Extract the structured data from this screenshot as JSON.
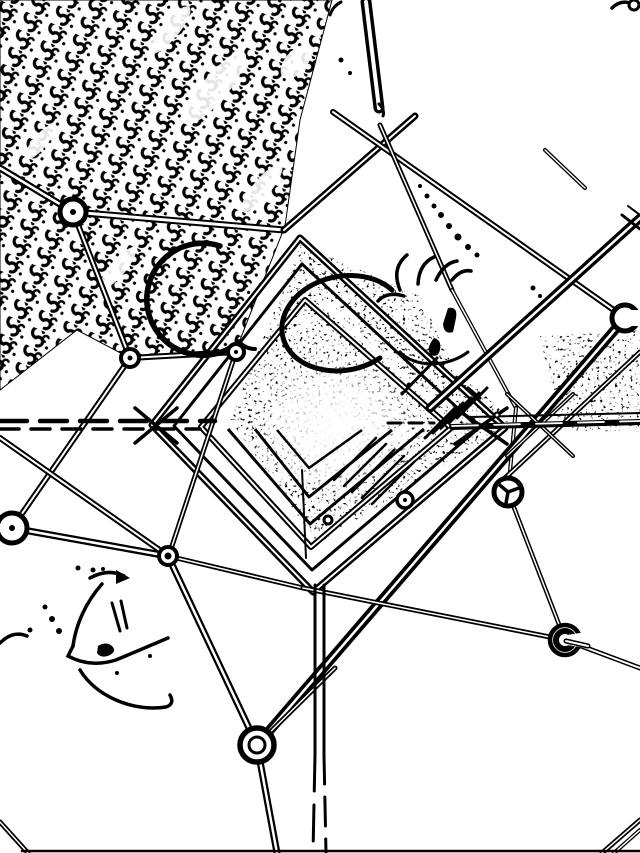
{
  "image": {
    "kind": "edge-detected-photograph",
    "alt": "Black and white edge-detection line art of a lattice tower viewed along its axis: radiating double-line struts with circular ring joints, nested diamond frames around a speckled noisy core, chain-like foliage texture in the upper-left, dashed guide lines, and small curved details",
    "width": 640,
    "height": 853,
    "palette": {
      "ink": "#000000",
      "paper": "#ffffff"
    }
  },
  "scene": {
    "texture": {
      "polygon": "0,0 332,0 300,120 285,226 236,350 130,358 77,330 0,390",
      "white_streaks": [
        [
          215,
          88,
          46,
          13
        ],
        [
          262,
          188,
          30,
          9
        ],
        [
          118,
          268,
          26,
          8
        ],
        [
          40,
          142,
          22,
          7
        ],
        [
          170,
          30,
          30,
          9
        ],
        [
          296,
          62,
          20,
          11
        ]
      ]
    },
    "noise": {
      "polygons": [
        "300,248 516,420 318,544 230,420",
        "540,336 640,330 640,432 560,430",
        "292,240 420,296 468,396 330,302"
      ],
      "fade_center": [
        336,
        428,
        85,
        75
      ],
      "white_streaks": [
        [
          318,
          300,
          430,
          400,
          5
        ],
        [
          280,
          340,
          360,
          290,
          4
        ],
        [
          330,
          480,
          420,
          420,
          4
        ]
      ]
    },
    "diamonds_double": [
      {
        "points": "300,238 505,428 313,592 152,425",
        "bw": 7,
        "ww": 2
      },
      {
        "points": "305,300 451,428 311,547 201,427",
        "bw": 6,
        "ww": 2
      }
    ],
    "diamonds_single": [
      {
        "points": "302,264 479,428 312,570 174,426",
        "w": 3
      }
    ],
    "chevrons": [
      {
        "points": "228,429 310,524 424,429",
        "w": 3
      },
      {
        "points": "255,429 309,497 392,430",
        "w": 3
      },
      {
        "points": "277,430 309,468 362,430",
        "w": 2.5
      }
    ],
    "struts": [
      [
        0,
        168,
        73,
        212,
        7,
        2.5
      ],
      [
        73,
        212,
        284,
        230,
        7,
        3
      ],
      [
        73,
        212,
        130,
        358,
        6,
        2
      ],
      [
        130,
        358,
        236,
        352,
        6,
        2
      ],
      [
        130,
        358,
        12,
        528,
        6,
        2
      ],
      [
        0,
        438,
        168,
        556,
        6,
        2
      ],
      [
        12,
        528,
        168,
        556,
        7,
        2.5
      ],
      [
        168,
        556,
        257,
        745,
        7,
        2.5
      ],
      [
        168,
        556,
        303,
        588,
        5,
        1.5
      ],
      [
        236,
        352,
        170,
        552,
        5,
        1.5
      ],
      [
        284,
        230,
        415,
        116,
        7,
        2
      ],
      [
        333,
        112,
        625,
        318,
        6,
        2
      ],
      [
        380,
        125,
        452,
        290,
        5,
        1.5
      ],
      [
        452,
        290,
        516,
        408,
        4,
        1.5
      ],
      [
        516,
        408,
        508,
        492,
        4,
        1.5
      ],
      [
        508,
        492,
        565,
        640,
        4.5,
        1.5
      ],
      [
        625,
        318,
        257,
        745,
        10,
        2.5
      ],
      [
        640,
        218,
        430,
        408,
        9,
        2.5
      ],
      [
        565,
        640,
        640,
        668,
        5,
        2
      ],
      [
        565,
        640,
        303,
        588,
        5,
        1.5
      ],
      [
        257,
        745,
        277,
        853,
        7,
        2.5
      ],
      [
        257,
        745,
        335,
        668,
        5,
        1.5
      ],
      [
        366,
        2,
        379,
        108,
        11,
        4
      ],
      [
        0,
        822,
        28,
        853,
        5,
        1.5
      ],
      [
        602,
        853,
        640,
        820,
        5,
        1.5
      ],
      [
        614,
        853,
        640,
        830,
        4,
        1.5
      ],
      [
        545,
        150,
        585,
        188,
        4,
        1.5
      ],
      [
        640,
        352,
        505,
        478,
        5,
        1.5
      ],
      [
        507,
        394,
        573,
        456,
        4,
        1.2
      ],
      [
        573,
        394,
        507,
        456,
        4,
        1.2
      ]
    ],
    "singles": [
      [
        135,
        408,
        177,
        443,
        3.5
      ],
      [
        135,
        443,
        177,
        408,
        3.5
      ],
      [
        455,
        408,
        507,
        444,
        3.5
      ],
      [
        455,
        444,
        507,
        408,
        3.5
      ],
      [
        302,
        470,
        306,
        558,
        2
      ],
      [
        315,
        585,
        315,
        755,
        3
      ],
      [
        324,
        585,
        324,
        755,
        3
      ],
      [
        622,
        215,
        640,
        229,
        3
      ],
      [
        628,
        206,
        640,
        215,
        2
      ],
      [
        22,
        851,
        640,
        851,
        2.5
      ],
      [
        402,
        394,
        437,
        358,
        3
      ],
      [
        468,
        388,
        480,
        398,
        3
      ],
      [
        452,
        427,
        640,
        422,
        6
      ],
      [
        470,
        417,
        640,
        413,
        2
      ],
      [
        425,
        438,
        455,
        408,
        3
      ],
      [
        433,
        433,
        463,
        403,
        3
      ],
      [
        441,
        428,
        471,
        398,
        3
      ],
      [
        449,
        423,
        479,
        393,
        3
      ],
      [
        457,
        418,
        487,
        388,
        3
      ],
      [
        334,
        480,
        376,
        438,
        2.5
      ],
      [
        344,
        486,
        386,
        444,
        2.5
      ],
      [
        352,
        492,
        394,
        450,
        2.5
      ],
      [
        362,
        498,
        404,
        456,
        2.5
      ],
      [
        372,
        504,
        414,
        462,
        2.5
      ]
    ],
    "dashed": [
      [
        0,
        421,
        215,
        421,
        4.5,
        "27 13",
        "#000"
      ],
      [
        0,
        429,
        200,
        429,
        3.5,
        "19 12",
        "#000"
      ],
      [
        388,
        423,
        434,
        423,
        3,
        "13 8",
        "#000"
      ],
      [
        315,
        755,
        313,
        853,
        3,
        "36 14",
        "#000"
      ],
      [
        324,
        755,
        326,
        853,
        3,
        "29 13",
        "#000"
      ],
      [
        452,
        426,
        640,
        421,
        1.8,
        "26 16",
        "#fff"
      ]
    ],
    "paths": [
      {
        "d": "M220,246 A56,56 0 1 0 239,342",
        "sw": 5.5
      },
      {
        "d": "M239,342 q7,7 16,7",
        "sw": 4
      },
      {
        "d": "M220,246 q-7,-5 -14,-2",
        "sw": 3
      },
      {
        "d": "M380,358 A62,47 -12 1 1 392,290",
        "sw": 5
      },
      {
        "d": "M400,352 A45,32 -12 0 0 468,352",
        "sw": 3
      },
      {
        "d": "M400,290 q-9,-22 7,-35",
        "sw": 3.5
      },
      {
        "d": "M418,284 q1,-20 16,-27",
        "sw": 3.5
      },
      {
        "d": "M436,280 q8,-17 21,-19",
        "sw": 3.5
      },
      {
        "d": "M404,296 q-17,-5 -26,5",
        "sw": 3.5
      },
      {
        "d": "M452,280 q9,-11 19,-9",
        "sw": 3.5
      },
      {
        "d": "M448,308 q10,-2 8,10 l-3,14 q-9,3 -10,-8 z",
        "fill": true
      },
      {
        "d": "M434,338 q8,2 6,12 q-2,8 -9,5 q-6,-6 3,-17 z",
        "fill": true
      },
      {
        "d": "M612,8 q10,-10 23,-3",
        "sw": 3.5
      },
      {
        "d": "M0,643 q13,-13 27,-7",
        "sw": 3.5
      },
      {
        "d": "M330,15 q3,-9 11,-13",
        "sw": 3
      },
      {
        "d": "M379,104 q6,6 4,12",
        "sw": 3
      },
      {
        "d": "M90,578 q18,-10 34,-2",
        "sw": 3.5
      },
      {
        "d": "M116,570 l14,8 l-14,6 z",
        "fill": true
      },
      {
        "d": "M102,584 C86,602 76,624 73,646",
        "sw": 3.5
      },
      {
        "d": "M73,646 l-5,10 q22,12 48,4 l52,-22",
        "sw": 3.5
      },
      {
        "d": "M80,670 C96,696 132,712 166,707 q9,-3 4,-12",
        "sw": 3.5
      },
      {
        "d": "M112,603 l8,28",
        "sw": 3
      },
      {
        "d": "M121,601 l6,27",
        "sw": 3
      },
      {
        "d": "M98,646 q8,-5 14,0 q5,5 -2,9 q-9,4 -13,-2 z",
        "fill": true
      }
    ],
    "rings": [
      {
        "x": 73,
        "y": 212,
        "r": 13,
        "sw": 5,
        "dot": 3
      },
      {
        "x": 130,
        "y": 358,
        "r": 9,
        "sw": 4,
        "dot": 2.5
      },
      {
        "x": 236,
        "y": 352,
        "r": 8,
        "sw": 4,
        "dot": 2
      },
      {
        "x": 12,
        "y": 528,
        "r": 15,
        "sw": 5,
        "dot": 3
      },
      {
        "x": 168,
        "y": 556,
        "r": 9,
        "sw": 4,
        "dot": 3.5
      },
      {
        "x": 508,
        "y": 492,
        "r": 14,
        "sw": 5,
        "spokes": 3
      },
      {
        "x": 565,
        "y": 640,
        "r": 15,
        "sw": 4.5,
        "copen": true
      },
      {
        "x": 257,
        "y": 745,
        "r": 17,
        "sw": 5.5,
        "inner_r": 8,
        "inner_sw": 3
      },
      {
        "x": 625,
        "y": 318,
        "r": 13,
        "sw": 5,
        "notch": "right"
      },
      {
        "x": 405,
        "y": 500,
        "r": 8,
        "sw": 3.5,
        "dot": 2
      },
      {
        "x": 497,
        "y": 415,
        "r": 2.5,
        "sw": 2
      },
      {
        "x": 634,
        "y": 5,
        "r": 5,
        "sw": 3
      },
      {
        "x": 328,
        "y": 520,
        "r": 4,
        "sw": 3
      }
    ],
    "dots": [
      [
        420,
        186,
        2
      ],
      [
        427,
        196,
        2.5
      ],
      [
        434,
        206,
        2.5
      ],
      [
        441,
        215,
        3
      ],
      [
        449,
        226,
        3
      ],
      [
        458,
        237,
        3.5
      ],
      [
        468,
        247,
        3
      ],
      [
        477,
        255,
        2.5
      ],
      [
        533,
        288,
        2.5
      ],
      [
        540,
        296,
        2
      ],
      [
        341,
        60,
        2.5
      ],
      [
        350,
        73,
        2
      ],
      [
        45,
        607,
        2.5
      ],
      [
        52,
        619,
        3
      ],
      [
        59,
        631,
        3
      ],
      [
        117,
        673,
        2
      ],
      [
        150,
        656,
        2
      ],
      [
        78,
        568,
        2.5
      ],
      [
        93,
        570,
        2.5
      ],
      [
        103,
        569,
        2
      ],
      [
        30,
        630,
        2.5
      ],
      [
        409,
        385,
        2.5
      ]
    ]
  }
}
